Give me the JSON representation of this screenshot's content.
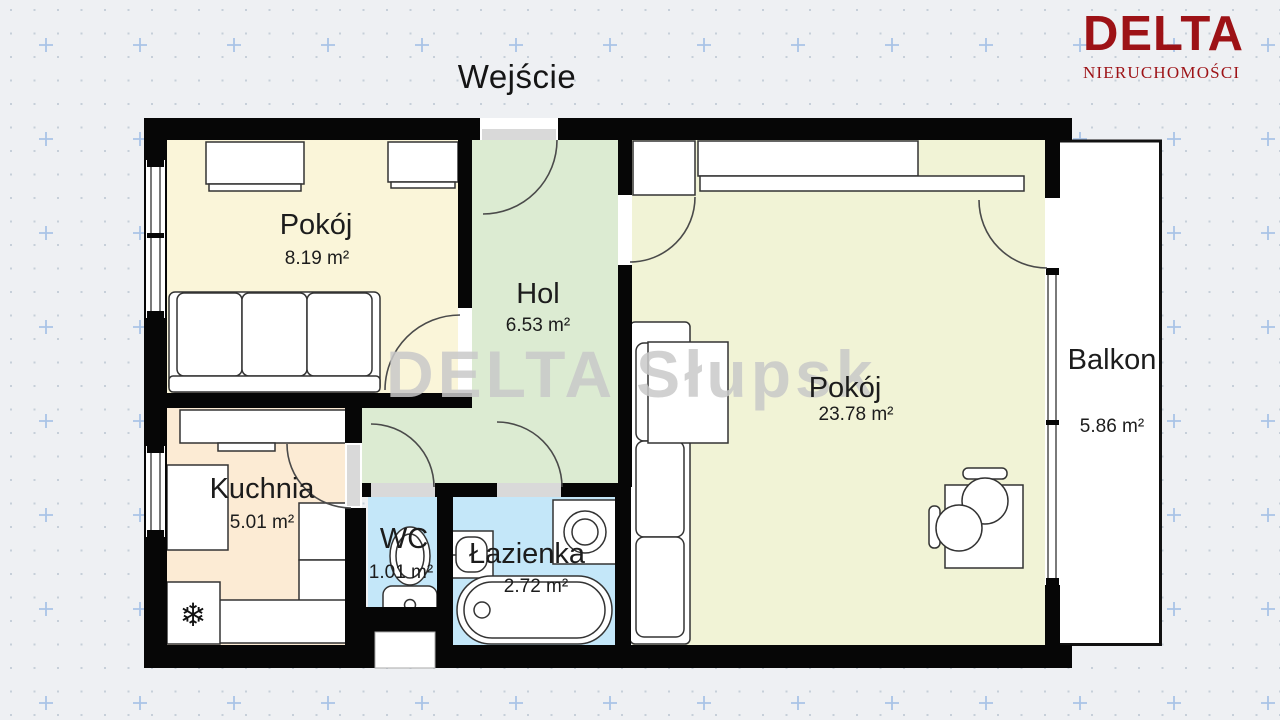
{
  "title": "Wejście",
  "logo": {
    "brand": "DELTA",
    "tagline": "NIERUCHOMOŚCI"
  },
  "watermark": "DELTA Słupsk",
  "rooms": {
    "pokoj1": {
      "label": "Pokój",
      "area": "8.19 m²",
      "color": "#faf5d9"
    },
    "hol": {
      "label": "Hol",
      "area": "6.53 m²",
      "color": "#dcebd2"
    },
    "pokoj2": {
      "label": "Pokój",
      "area": "23.78 m²",
      "color": "#f1f3d6"
    },
    "kuchnia": {
      "label": "Kuchnia",
      "area": "5.01 m²",
      "color": "#fcebd4"
    },
    "wc": {
      "label": "WC",
      "area": "1.01 m²",
      "color": "#c4e7f9"
    },
    "lazienka": {
      "label": "Łazienka",
      "area": "2.72 m²",
      "color": "#c4e7f9"
    },
    "balkon": {
      "label": "Balkon",
      "area": "5.86 m²",
      "color": "#ffffff"
    }
  },
  "colors": {
    "wall": "#060606",
    "background": "#eef0f3",
    "threshold": "#d9d9d9",
    "furniture_stroke": "#333333",
    "door_arc": "#4a4a4a",
    "label": "#1c1c1c",
    "logo_red": "#9d1216",
    "watermark_gray": "#c9c9c9",
    "grid_dot": "#c6cfd9",
    "grid_plus": "#a9c4e6"
  },
  "icons": {
    "fridge_snowflake": "❄"
  }
}
